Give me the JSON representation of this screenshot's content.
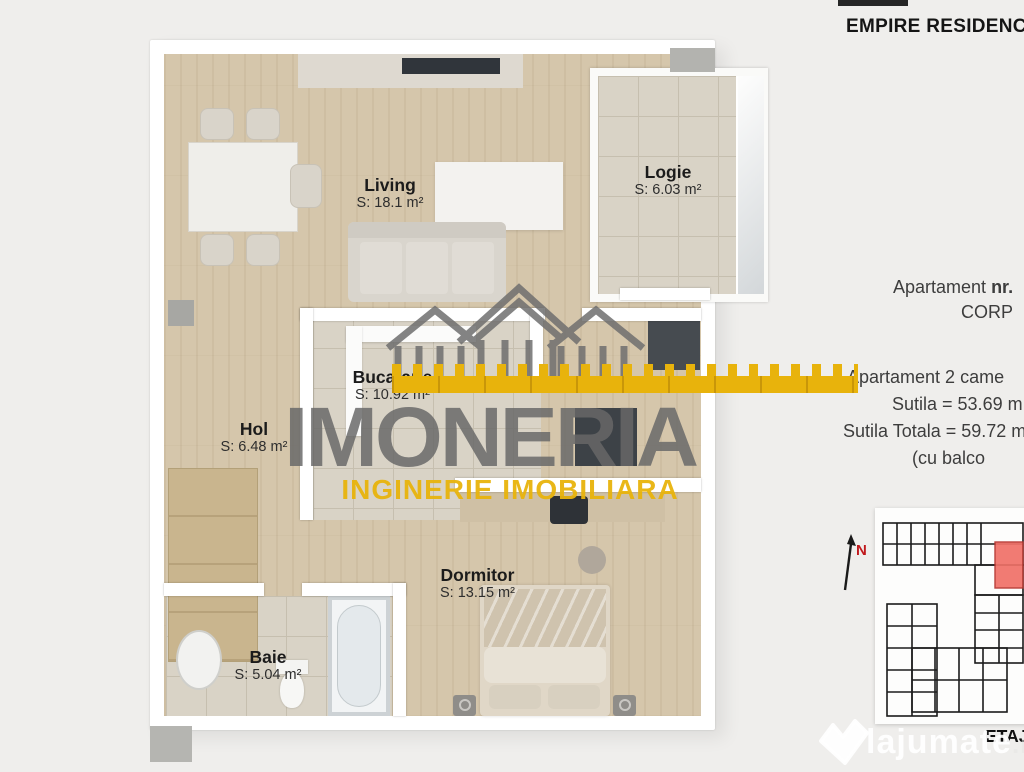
{
  "page": {
    "background": "#efeeec"
  },
  "header": {
    "title": "EMPIRE RESIDENC"
  },
  "floorplan": {
    "rooms": [
      {
        "name": "Living",
        "area": "S: 18.1 m²"
      },
      {
        "name": "Logie",
        "area": "S: 6.03 m²"
      },
      {
        "name": "Bucatarie",
        "area": "S: 10.92 m²"
      },
      {
        "name": "Hol",
        "area": "S: 6.48 m²"
      },
      {
        "name": "Dormitor",
        "area": "S: 13.15 m²"
      },
      {
        "name": "Baie",
        "area": "S: 5.04 m²"
      }
    ],
    "watermark": {
      "brand": "IMONERIA",
      "tagline": "INGINERIE IMOBILIARA",
      "brand_color": "#6f6f6f",
      "accent_color": "#e8b30c"
    }
  },
  "sidebar": {
    "apartment_prefix": "Apartament ",
    "apartment_nr": "nr.",
    "corp_label": "CORP",
    "details": [
      "Apartament 2 came",
      "Sutila = 53.69 m",
      "Sutila Totala = 59.72 m",
      "(cu balco"
    ],
    "floor_label": "ETAJ",
    "compass_label": "N",
    "siteplan_highlight": "#f07168"
  },
  "branding": {
    "site_watermark": "lajumate",
    "site_domain": ".ro"
  }
}
